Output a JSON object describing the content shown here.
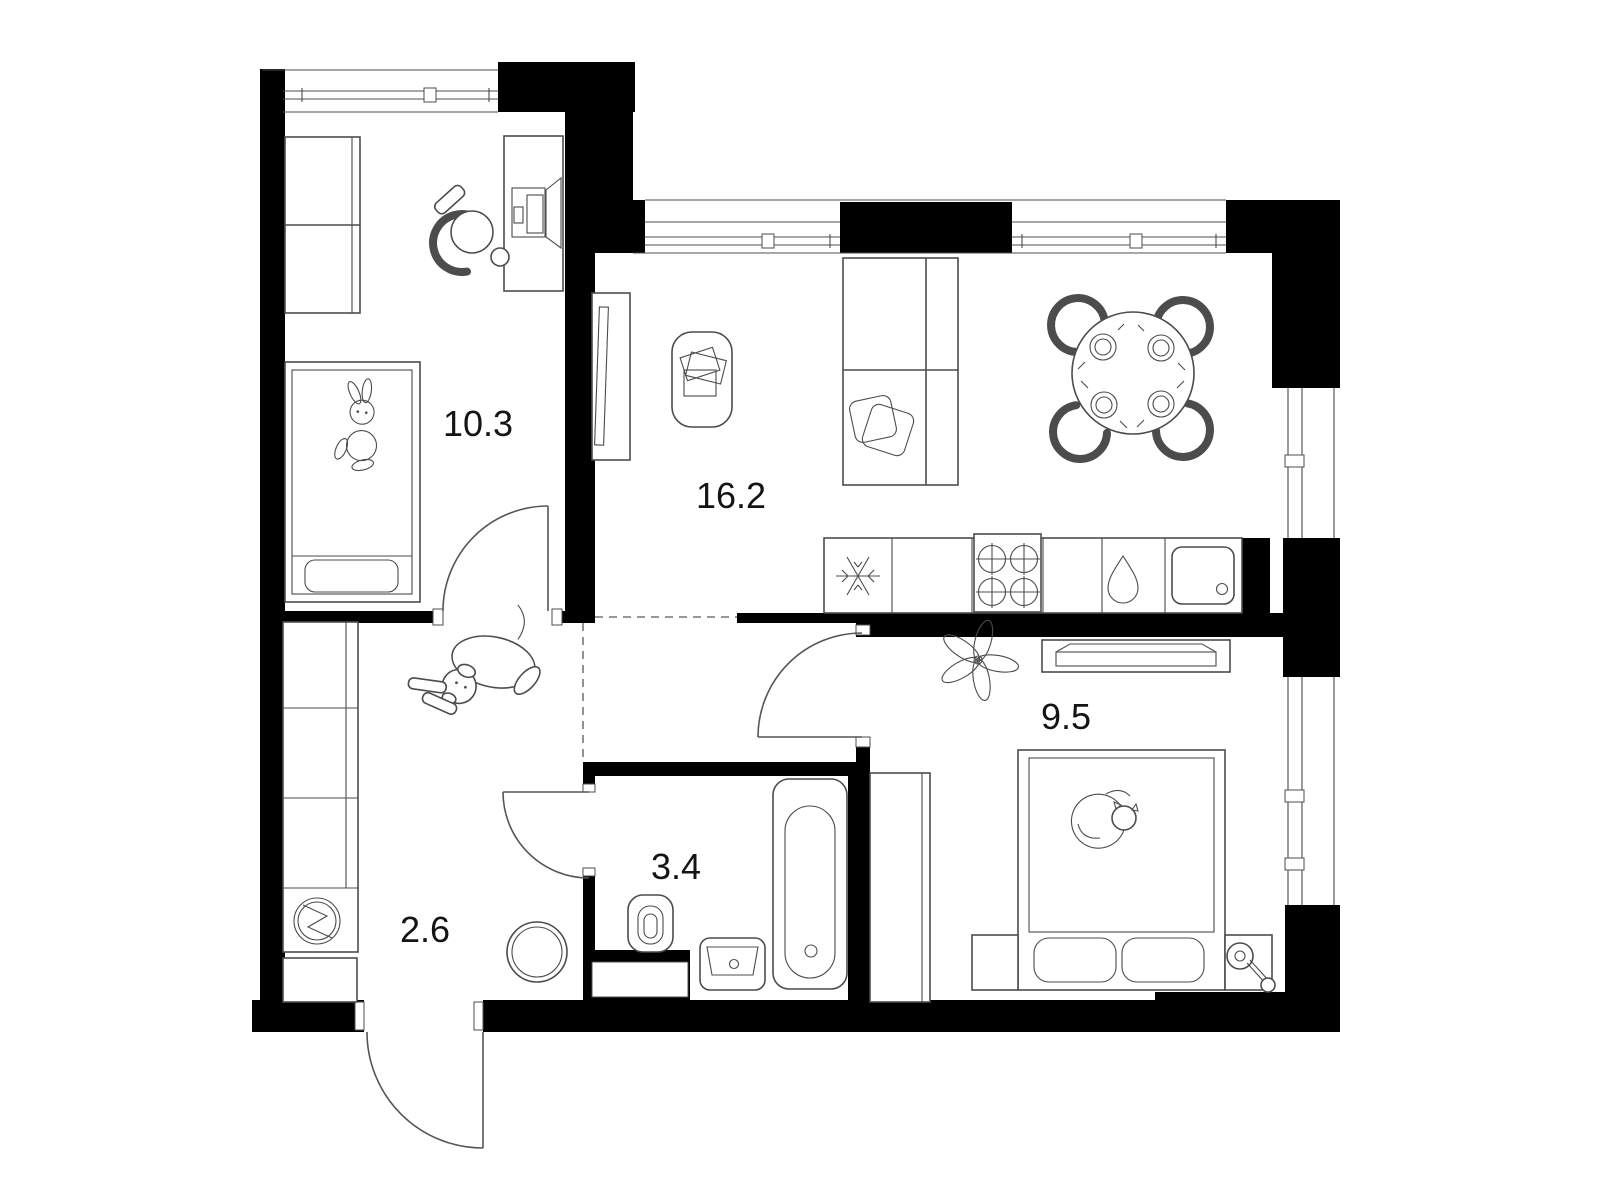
{
  "plan_title": "two-room apartment floor plan",
  "colors": {
    "wall": "#000000",
    "background": "#ffffff",
    "furniture_line": "#4c4c4c",
    "label_text": "#141414"
  },
  "rooms": [
    {
      "id": "children-bedroom",
      "area_label": "10.3",
      "furniture": [
        "wardrobe",
        "desk",
        "monitor",
        "desk-chair",
        "single-bed",
        "bunny-toy"
      ]
    },
    {
      "id": "living-kitchen",
      "area_label": "16.2",
      "furniture": [
        "tv-stand",
        "tv",
        "coffee-table",
        "sofa",
        "pillows",
        "dining-table",
        "dining-chairs",
        "kitchen-counter",
        "fridge",
        "stove",
        "dishwasher",
        "kitchen-sink"
      ]
    },
    {
      "id": "hallway",
      "area_label": "2.6",
      "furniture": [
        "wardrobe",
        "washing-machine",
        "shoe-cabinet",
        "round-stool",
        "dog"
      ]
    },
    {
      "id": "bathroom",
      "area_label": "3.4",
      "furniture": [
        "toilet",
        "washbasin",
        "bathtub"
      ]
    },
    {
      "id": "bedroom",
      "area_label": "9.5",
      "furniture": [
        "dresser",
        "plant",
        "wardrobe",
        "double-bed",
        "pillows",
        "cat",
        "nightstand-left",
        "nightstand-right",
        "lamp"
      ]
    }
  ],
  "openings": {
    "windows": [
      "children-room-window-top",
      "living-room-window-top-left",
      "living-room-window-top-right",
      "dining-window-right",
      "bedroom-window-right"
    ],
    "doors": [
      "entrance-door",
      "children-room-door",
      "bedroom-door",
      "bathroom-door"
    ]
  }
}
